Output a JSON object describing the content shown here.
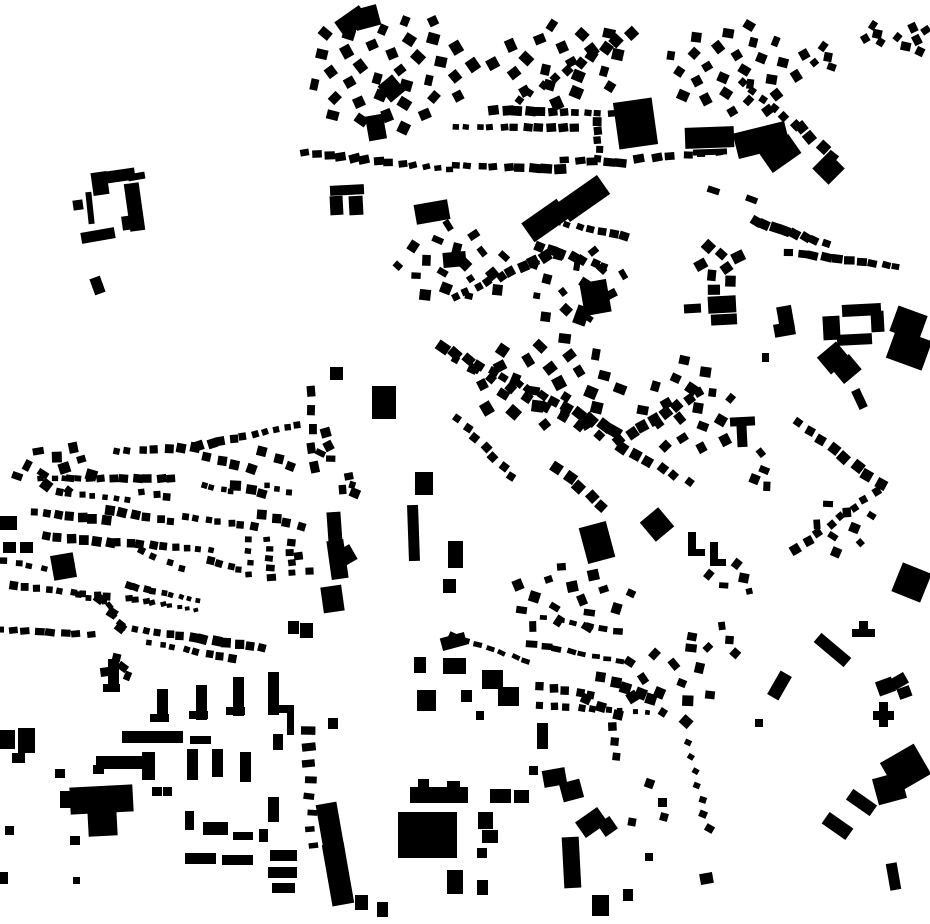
{
  "map": {
    "width": 930,
    "height": 924,
    "background_color": "#ffffff",
    "building_color": "#000000"
  },
  "buildings": [
    [
      92,
      172,
      16,
      23,
      -8
    ],
    [
      99,
      170,
      36,
      12,
      -8
    ],
    [
      128,
      173,
      17,
      7,
      -10
    ],
    [
      127,
      183,
      15,
      48,
      -8
    ],
    [
      122,
      216,
      10,
      14,
      -8
    ],
    [
      87,
      192,
      6,
      32,
      -6
    ],
    [
      73,
      200,
      10,
      10,
      -8
    ],
    [
      81,
      230,
      34,
      11,
      -10
    ],
    [
      92,
      277,
      11,
      17,
      -20
    ],
    [
      337,
      12,
      30,
      19,
      -35
    ],
    [
      354,
      7,
      25,
      21,
      -15
    ],
    [
      382,
      78,
      19,
      21,
      -40
    ],
    [
      367,
      115,
      18,
      25,
      -10
    ],
    [
      330,
      185,
      34,
      10,
      -3
    ],
    [
      330,
      196,
      13,
      19,
      -3
    ],
    [
      349,
      196,
      14,
      19,
      -3
    ],
    [
      415,
      202,
      34,
      20,
      -10
    ],
    [
      524,
      209,
      43,
      23,
      -35
    ],
    [
      559,
      187,
      49,
      23,
      -35
    ],
    [
      616,
      100,
      39,
      47,
      -8
    ],
    [
      685,
      127,
      49,
      21,
      -2
    ],
    [
      693,
      149,
      34,
      6,
      -2
    ],
    [
      735,
      127,
      53,
      26,
      -14
    ],
    [
      763,
      142,
      35,
      23,
      -35
    ],
    [
      817,
      157,
      23,
      23,
      45
    ],
    [
      443,
      252,
      23,
      15,
      -5
    ],
    [
      582,
      281,
      27,
      33,
      -10
    ],
    [
      575,
      306,
      13,
      19,
      20
    ],
    [
      372,
      386,
      24,
      33,
      0
    ],
    [
      842,
      304,
      39,
      12,
      -3
    ],
    [
      823,
      316,
      17,
      24,
      -3
    ],
    [
      837,
      334,
      35,
      11,
      -3
    ],
    [
      871,
      311,
      13,
      21,
      -3
    ],
    [
      893,
      310,
      31,
      27,
      20
    ],
    [
      890,
      334,
      38,
      31,
      20
    ],
    [
      821,
      347,
      25,
      22,
      -40
    ],
    [
      835,
      359,
      23,
      20,
      -40
    ],
    [
      778,
      306,
      15,
      23,
      -10
    ],
    [
      774,
      323,
      21,
      13,
      -10
    ],
    [
      708,
      296,
      28,
      17,
      -3
    ],
    [
      711,
      314,
      26,
      11,
      -3
    ],
    [
      684,
      304,
      17,
      9,
      -3
    ],
    [
      762,
      353,
      7,
      9,
      0
    ],
    [
      855,
      389,
      9,
      20,
      -25
    ],
    [
      730,
      417,
      25,
      9,
      -3
    ],
    [
      737,
      425,
      10,
      22,
      -3
    ],
    [
      645,
      512,
      24,
      25,
      -40
    ],
    [
      688,
      532,
      8,
      21,
      0
    ],
    [
      688,
      549,
      17,
      7,
      0
    ],
    [
      710,
      542,
      8,
      21,
      0
    ],
    [
      710,
      559,
      16,
      7,
      0
    ],
    [
      896,
      567,
      31,
      31,
      22
    ],
    [
      873,
      711,
      21,
      9,
      0
    ],
    [
      879,
      702,
      9,
      25,
      0
    ],
    [
      877,
      679,
      17,
      15,
      -20
    ],
    [
      892,
      675,
      15,
      12,
      -30
    ],
    [
      898,
      687,
      13,
      11,
      -20
    ],
    [
      886,
      751,
      39,
      35,
      -30
    ],
    [
      875,
      775,
      29,
      27,
      -15
    ],
    [
      847,
      796,
      29,
      13,
      35
    ],
    [
      823,
      819,
      29,
      14,
      35
    ],
    [
      888,
      863,
      11,
      27,
      -10
    ],
    [
      813,
      644,
      39,
      12,
      40
    ],
    [
      852,
      629,
      23,
      8,
      0
    ],
    [
      859,
      621,
      9,
      13,
      0
    ],
    [
      773,
      672,
      13,
      27,
      30
    ],
    [
      415,
      472,
      18,
      23,
      0
    ],
    [
      408,
      505,
      11,
      56,
      -2
    ],
    [
      448,
      541,
      15,
      27,
      0
    ],
    [
      443,
      579,
      13,
      14,
      0
    ],
    [
      328,
      512,
      14,
      46,
      -4
    ],
    [
      331,
      549,
      24,
      17,
      -30
    ],
    [
      329,
      540,
      17,
      39,
      -8
    ],
    [
      322,
      586,
      21,
      26,
      -8
    ],
    [
      583,
      524,
      28,
      37,
      -15
    ],
    [
      330,
      367,
      13,
      13,
      0
    ],
    [
      441,
      635,
      25,
      13,
      -15
    ],
    [
      414,
      657,
      12,
      16,
      0
    ],
    [
      443,
      658,
      23,
      16,
      0
    ],
    [
      482,
      670,
      21,
      19,
      0
    ],
    [
      498,
      687,
      21,
      19,
      0
    ],
    [
      417,
      690,
      19,
      21,
      0
    ],
    [
      461,
      690,
      11,
      12,
      0
    ],
    [
      476,
      711,
      8,
      9,
      0
    ],
    [
      537,
      723,
      11,
      26,
      0
    ],
    [
      543,
      769,
      23,
      17,
      -10
    ],
    [
      561,
      781,
      21,
      19,
      -15
    ],
    [
      410,
      787,
      58,
      16,
      0
    ],
    [
      418,
      779,
      11,
      10,
      0
    ],
    [
      447,
      781,
      13,
      9,
      0
    ],
    [
      490,
      789,
      21,
      14,
      0
    ],
    [
      514,
      790,
      15,
      13,
      0
    ],
    [
      478,
      812,
      15,
      17,
      0
    ],
    [
      482,
      830,
      16,
      13,
      0
    ],
    [
      477,
      848,
      10,
      10,
      0
    ],
    [
      398,
      812,
      59,
      46,
      0
    ],
    [
      320,
      803,
      21,
      52,
      -10
    ],
    [
      327,
      843,
      22,
      62,
      -10
    ],
    [
      447,
      870,
      16,
      24,
      0
    ],
    [
      477,
      880,
      11,
      15,
      0
    ],
    [
      563,
      837,
      17,
      51,
      -3
    ],
    [
      578,
      813,
      27,
      19,
      -35
    ],
    [
      600,
      819,
      15,
      15,
      -35
    ],
    [
      592,
      895,
      17,
      21,
      0
    ],
    [
      529,
      766,
      9,
      9,
      0
    ],
    [
      328,
      718,
      10,
      11,
      0
    ],
    [
      355,
      895,
      13,
      15,
      0
    ],
    [
      377,
      902,
      11,
      15,
      0
    ],
    [
      108,
      659,
      11,
      31,
      0
    ],
    [
      103,
      684,
      17,
      8,
      0
    ],
    [
      157,
      689,
      11,
      33,
      0
    ],
    [
      150,
      714,
      19,
      8,
      0
    ],
    [
      196,
      685,
      11,
      35,
      0
    ],
    [
      189,
      711,
      19,
      8,
      0
    ],
    [
      233,
      677,
      11,
      39,
      0
    ],
    [
      226,
      707,
      19,
      8,
      0
    ],
    [
      268,
      672,
      11,
      43,
      0
    ],
    [
      279,
      705,
      15,
      8,
      0
    ],
    [
      122,
      731,
      61,
      12,
      0
    ],
    [
      190,
      736,
      21,
      8,
      0
    ],
    [
      96,
      756,
      59,
      13,
      0
    ],
    [
      93,
      765,
      11,
      9,
      0
    ],
    [
      142,
      752,
      13,
      28,
      0
    ],
    [
      187,
      749,
      11,
      31,
      0
    ],
    [
      212,
      749,
      11,
      28,
      0
    ],
    [
      240,
      752,
      11,
      30,
      0
    ],
    [
      273,
      734,
      10,
      16,
      0
    ],
    [
      287,
      706,
      7,
      29,
      0
    ],
    [
      268,
      797,
      11,
      25,
      0
    ],
    [
      185,
      811,
      9,
      19,
      0
    ],
    [
      70,
      786,
      63,
      27,
      -3
    ],
    [
      88,
      809,
      29,
      27,
      -3
    ],
    [
      60,
      791,
      13,
      17,
      0
    ],
    [
      152,
      787,
      10,
      9,
      0
    ],
    [
      163,
      787,
      9,
      9,
      0
    ],
    [
      203,
      822,
      25,
      13,
      0
    ],
    [
      233,
      832,
      20,
      8,
      0
    ],
    [
      259,
      829,
      9,
      13,
      0
    ],
    [
      185,
      853,
      31,
      11,
      0
    ],
    [
      222,
      855,
      31,
      10,
      0
    ],
    [
      270,
      850,
      27,
      11,
      0
    ],
    [
      268,
      867,
      29,
      11,
      0
    ],
    [
      272,
      883,
      23,
      10,
      0
    ],
    [
      0,
      730,
      15,
      19,
      0
    ],
    [
      18,
      728,
      17,
      25,
      0
    ],
    [
      12,
      753,
      13,
      10,
      0
    ],
    [
      3,
      542,
      13,
      11,
      0
    ],
    [
      20,
      542,
      13,
      11,
      0
    ],
    [
      0,
      516,
      17,
      14,
      0
    ],
    [
      52,
      554,
      23,
      25,
      -10
    ],
    [
      55,
      769,
      10,
      9,
      0
    ],
    [
      5,
      826,
      9,
      9,
      0
    ],
    [
      70,
      836,
      10,
      9,
      0
    ],
    [
      73,
      877,
      7,
      7,
      0
    ],
    [
      0,
      872,
      8,
      12,
      0
    ],
    [
      288,
      621,
      11,
      13,
      0
    ],
    [
      300,
      623,
      13,
      15,
      0
    ],
    [
      623,
      889,
      10,
      12,
      0
    ],
    [
      645,
      853,
      8,
      8,
      0
    ],
    [
      700,
      873,
      13,
      11,
      -10
    ],
    [
      645,
      779,
      9,
      9,
      20
    ],
    [
      658,
      798,
      9,
      9,
      0
    ],
    [
      628,
      818,
      8,
      8,
      10
    ],
    [
      660,
      813,
      8,
      8,
      15
    ],
    [
      755,
      719,
      8,
      8,
      0
    ]
  ],
  "rows": [
    [
      495,
      111,
      610,
      114,
      11,
      9,
      8,
      0
    ],
    [
      455,
      128,
      575,
      129,
      11,
      8,
      7,
      0
    ],
    [
      630,
      32,
      518,
      99,
      10,
      9,
      9,
      40
    ],
    [
      597,
      123,
      599,
      160,
      5,
      9,
      9,
      0
    ],
    [
      305,
      151,
      450,
      168,
      13,
      9,
      7,
      -8
    ],
    [
      455,
      164,
      560,
      168,
      9,
      10,
      8,
      0
    ],
    [
      565,
      161,
      622,
      164,
      5,
      10,
      7,
      0
    ],
    [
      640,
      157,
      718,
      151,
      6,
      9,
      7,
      -5
    ],
    [
      800,
      127,
      833,
      157,
      4,
      9,
      9,
      45
    ],
    [
      715,
      189,
      750,
      198,
      2,
      15,
      8,
      25
    ],
    [
      755,
      223,
      825,
      245,
      8,
      9,
      8,
      25
    ],
    [
      790,
      251,
      897,
      265,
      10,
      9,
      7,
      8
    ],
    [
      443,
      349,
      616,
      433,
      15,
      11,
      9,
      35
    ],
    [
      457,
      361,
      598,
      437,
      9,
      8,
      8,
      35
    ],
    [
      620,
      439,
      700,
      391,
      8,
      9,
      9,
      -35
    ],
    [
      622,
      447,
      688,
      481,
      6,
      9,
      9,
      35
    ],
    [
      455,
      297,
      545,
      257,
      9,
      9,
      9,
      -30
    ],
    [
      545,
      219,
      625,
      235,
      8,
      8,
      7,
      15
    ],
    [
      540,
      246,
      605,
      266,
      7,
      8,
      8,
      25
    ],
    [
      458,
      419,
      512,
      477,
      7,
      7,
      7,
      40
    ],
    [
      558,
      469,
      602,
      507,
      5,
      9,
      9,
      40
    ],
    [
      798,
      423,
      880,
      485,
      8,
      9,
      9,
      35
    ],
    [
      876,
      493,
      796,
      551,
      8,
      9,
      9,
      -35
    ],
    [
      742,
      81,
      795,
      124,
      6,
      9,
      9,
      40
    ],
    [
      115,
      451,
      195,
      447,
      7,
      8,
      8,
      5
    ],
    [
      200,
      445,
      298,
      424,
      10,
      8,
      8,
      -12
    ],
    [
      42,
      477,
      172,
      477,
      12,
      8,
      7,
      0
    ],
    [
      58,
      491,
      128,
      499,
      7,
      7,
      7,
      5
    ],
    [
      143,
      491,
      168,
      496,
      3,
      7,
      7,
      0
    ],
    [
      207,
      457,
      250,
      469,
      4,
      8,
      8,
      15
    ],
    [
      263,
      451,
      292,
      466,
      3,
      8,
      8,
      20
    ],
    [
      203,
      487,
      232,
      493,
      4,
      7,
      7,
      10
    ],
    [
      237,
      484,
      263,
      492,
      3,
      10,
      9,
      10
    ],
    [
      267,
      487,
      288,
      494,
      3,
      7,
      7,
      0
    ],
    [
      35,
      513,
      105,
      521,
      7,
      8,
      8,
      5
    ],
    [
      110,
      512,
      172,
      523,
      6,
      8,
      8,
      8
    ],
    [
      185,
      517,
      253,
      527,
      7,
      8,
      8,
      5
    ],
    [
      263,
      514,
      300,
      526,
      4,
      8,
      8,
      10
    ],
    [
      45,
      535,
      110,
      542,
      6,
      8,
      8,
      5
    ],
    [
      118,
      541,
      210,
      549,
      9,
      7,
      7,
      5
    ],
    [
      140,
      551,
      183,
      569,
      4,
      8,
      8,
      20
    ],
    [
      5,
      561,
      43,
      569,
      4,
      8,
      7,
      8
    ],
    [
      13,
      584,
      108,
      595,
      9,
      8,
      8,
      5
    ],
    [
      77,
      595,
      103,
      602,
      3,
      7,
      7,
      0
    ],
    [
      128,
      584,
      198,
      599,
      9,
      6,
      6,
      15
    ],
    [
      128,
      599,
      196,
      611,
      9,
      6,
      5,
      -10
    ],
    [
      100,
      597,
      122,
      626,
      3,
      8,
      8,
      40
    ],
    [
      108,
      607,
      120,
      625,
      3,
      7,
      5,
      45
    ],
    [
      123,
      627,
      262,
      647,
      13,
      8,
      8,
      8
    ],
    [
      150,
      641,
      232,
      657,
      8,
      7,
      7,
      12
    ],
    [
      0,
      631,
      90,
      636,
      8,
      8,
      6,
      0
    ],
    [
      210,
      559,
      240,
      568,
      4,
      7,
      7,
      10
    ],
    [
      248,
      539,
      250,
      574,
      4,
      8,
      7,
      0
    ],
    [
      268,
      539,
      271,
      577,
      5,
      8,
      6,
      0
    ],
    [
      290,
      544,
      292,
      574,
      4,
      7,
      6,
      0
    ],
    [
      300,
      557,
      308,
      572,
      2,
      8,
      7,
      0
    ],
    [
      311,
      391,
      313,
      467,
      5,
      10,
      13,
      -5
    ],
    [
      308,
      729,
      312,
      844,
      8,
      12,
      7,
      0
    ],
    [
      453,
      636,
      527,
      661,
      7,
      10,
      6,
      20
    ],
    [
      533,
      645,
      620,
      662,
      8,
      10,
      6,
      10
    ],
    [
      545,
      617,
      618,
      631,
      6,
      9,
      6,
      10
    ],
    [
      540,
      687,
      592,
      696,
      5,
      7,
      7,
      5
    ],
    [
      602,
      677,
      652,
      699,
      5,
      9,
      9,
      15
    ],
    [
      540,
      707,
      648,
      714,
      9,
      6,
      6,
      5
    ],
    [
      585,
      699,
      618,
      715,
      3,
      8,
      8,
      20
    ],
    [
      613,
      727,
      616,
      757,
      3,
      7,
      7,
      0
    ],
    [
      688,
      741,
      708,
      827,
      7,
      8,
      7,
      25
    ]
  ],
  "clusters": [
    [
      390,
      70,
      85,
      62,
      36,
      10,
      40
    ],
    [
      560,
      62,
      72,
      42,
      20,
      10,
      40
    ],
    [
      735,
      70,
      68,
      48,
      26,
      9,
      35
    ],
    [
      912,
      40,
      17,
      19,
      6,
      8,
      40
    ],
    [
      872,
      34,
      15,
      11,
      4,
      8,
      40
    ],
    [
      822,
      57,
      19,
      15,
      5,
      8,
      35
    ],
    [
      455,
      264,
      58,
      42,
      18,
      9,
      30
    ],
    [
      575,
      283,
      52,
      42,
      15,
      8,
      35
    ],
    [
      548,
      383,
      80,
      48,
      26,
      10,
      35
    ],
    [
      690,
      408,
      48,
      52,
      18,
      9,
      35
    ],
    [
      55,
      468,
      46,
      24,
      12,
      9,
      10
    ],
    [
      570,
      600,
      68,
      34,
      16,
      9,
      5
    ],
    [
      672,
      683,
      50,
      43,
      13,
      9,
      30
    ],
    [
      720,
      268,
      26,
      25,
      8,
      10,
      -20
    ],
    [
      760,
      470,
      12,
      22,
      4,
      8,
      30
    ],
    [
      845,
      528,
      38,
      28,
      8,
      8,
      20
    ],
    [
      735,
      578,
      28,
      20,
      5,
      8,
      15
    ],
    [
      348,
      485,
      12,
      11,
      4,
      8,
      0
    ],
    [
      325,
      446,
      10,
      17,
      4,
      8,
      0
    ],
    [
      115,
      667,
      22,
      12,
      4,
      8,
      10
    ],
    [
      720,
      640,
      30,
      20,
      5,
      8,
      20
    ]
  ]
}
